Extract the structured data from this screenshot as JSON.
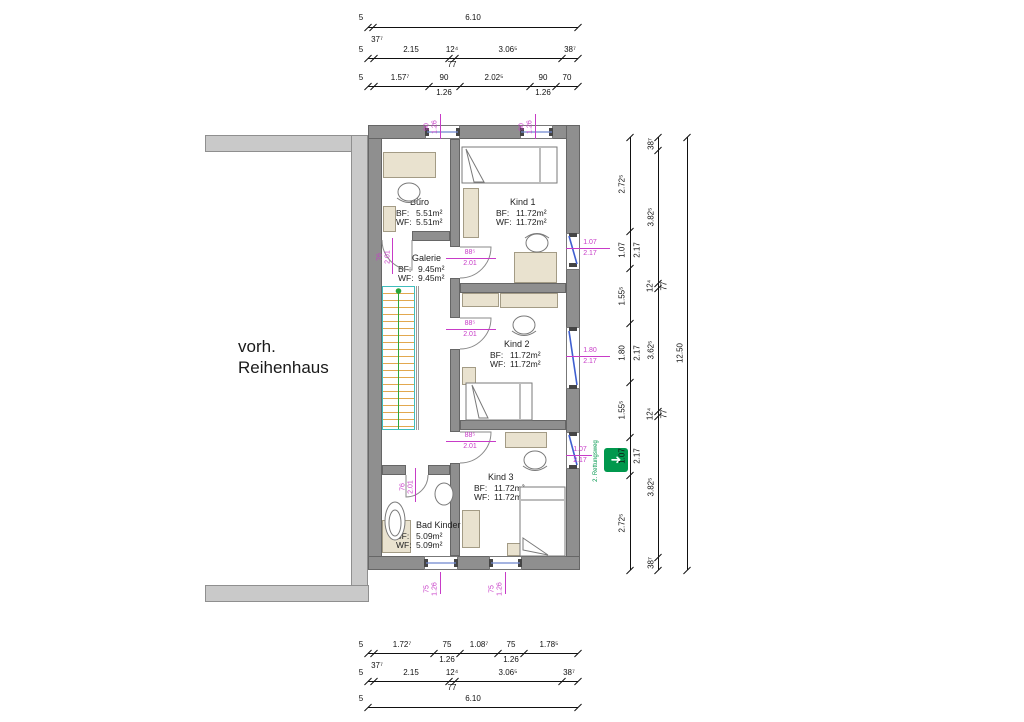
{
  "colors": {
    "wall": "#8f8f8f",
    "existing_wall": "#c9c9c9",
    "furniture": "#e9e2cf",
    "dimension_text": "#111111",
    "annotation_magenta": "#c73bc7",
    "window_blue": "#3f5fd0",
    "stair_outline": "#3fbdbd",
    "stair_steps": "#e2a84f",
    "stair_walkline": "#2aa63c",
    "exit_green": "#00984d"
  },
  "plan": {
    "existing_building_label": "vorh. Reihenhaus",
    "escape_route_label": "2. Rettungsweg",
    "area_labels": {
      "bf": "BF:",
      "wf": "WF:"
    },
    "rooms": [
      {
        "name": "Büro",
        "bf": "5.51m²",
        "wf": "5.51m²"
      },
      {
        "name": "Kind 1",
        "bf": "11.72m²",
        "wf": "11.72m²"
      },
      {
        "name": "Galerie",
        "bf": "9.45m²",
        "wf": "9.45m²"
      },
      {
        "name": "Kind 2",
        "bf": "11.72m²",
        "wf": "11.72m²"
      },
      {
        "name": "Kind 3",
        "bf": "11.72m²",
        "wf": "11.72m²"
      },
      {
        "name": "Bad Kinder",
        "bf": "5.09m²",
        "wf": "5.09m²"
      }
    ],
    "openings": {
      "doors": {
        "buero": {
          "w": "76",
          "h": "2.01"
        },
        "kind1": {
          "w": "88⁵",
          "h": "2.01"
        },
        "kind2": {
          "w": "88⁵",
          "h": "2.01"
        },
        "kind3": {
          "w": "88⁵",
          "h": "2.01"
        },
        "bad": {
          "w": "76",
          "h": "2.01"
        }
      },
      "windows": {
        "top1": {
          "w": "90",
          "h": "1.26"
        },
        "top2": {
          "w": "90",
          "h": "1.26"
        },
        "right1": {
          "w": "1.07",
          "h": "2.17"
        },
        "right2": {
          "w": "1.80",
          "h": "2.17"
        },
        "right3": {
          "w": "1.07",
          "h": "2.17"
        },
        "bottom1": {
          "w": "75",
          "h": "1.26"
        },
        "bottom2": {
          "w": "75",
          "h": "1.26"
        }
      }
    }
  },
  "dimensions": {
    "top": {
      "offset1": "5",
      "total": "6.10",
      "note": "37⁷",
      "offset2": "5",
      "r2d1": "2.15",
      "r2d2": "12⁴",
      "r2d2b": "77",
      "r2d3": "3.06⁵",
      "r2d4": "38⁷",
      "offset3": "5",
      "r3d1": "1.57⁷",
      "r3d2": "90",
      "r3d2b": "1.26",
      "r3d3": "2.02⁵",
      "r3d4": "90",
      "r3d4b": "1.26",
      "r3d5": "70"
    },
    "bottom": {
      "offset1": "5",
      "r1d1": "1.72⁷",
      "r1d2": "75",
      "r1d2b": "1.26",
      "r1d3": "1.08⁷",
      "r1d4": "75",
      "r1d4b": "1.26",
      "r1d5": "1.78⁵",
      "note": "37⁷",
      "offset2": "5",
      "r2d1": "2.15",
      "r2d2": "12⁴",
      "r2d2b": "77",
      "r2d3": "3.06⁵",
      "r2d4": "38⁷",
      "offset3": "5",
      "total": "6.10"
    },
    "right": {
      "col1": [
        "2.72⁵",
        "1.07",
        "2.17",
        "1.55⁵",
        "1.80",
        "2.17",
        "1.55⁵",
        "1.07",
        "2.17",
        "2.72⁵"
      ],
      "col2": [
        "38⁷",
        "3.82⁵",
        "12⁴",
        "77",
        "3.62⁵",
        "12⁴",
        "77",
        "3.82⁵",
        "38⁷"
      ],
      "col3_total": "12.50"
    }
  }
}
